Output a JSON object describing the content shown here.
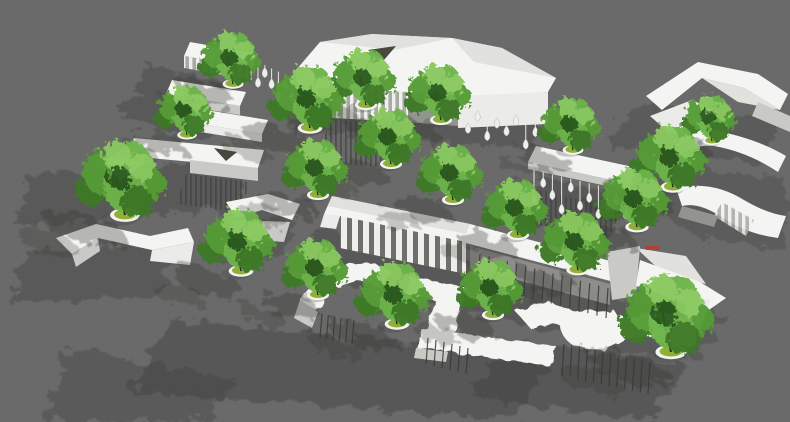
{
  "scene": {
    "width": 790,
    "height": 422,
    "description": "Aerial 3D rendering of a site model: white sculptural pavilions and canopies with green trees in round white planters on a gray ground, shadows cast toward the lower left"
  },
  "palette": {
    "ground": "#6a6a6a",
    "groundDot": "#626262",
    "shadow": "#3c3c3c",
    "treeShadow": "#35352f",
    "roof": "#f4f4f2",
    "roofShade": "#e1e1de",
    "faceLight": "#ebebe9",
    "faceMid": "#c9c9c6",
    "faceDark": "#93938f",
    "hole": "#48483f",
    "slatLight": "#f0f0ee",
    "slatDark": "#a9a9a5",
    "colLight": "#eeeeeb",
    "colDark": "#6e6e6a",
    "stick": "#383834",
    "dropLine": "#e9e9e6",
    "dropFill": "#efefec",
    "dropEdge": "#b5b5b1",
    "trunk": "#26241c",
    "canopy1": "#3c7a26",
    "canopy2": "#549c36",
    "canopy3": "#6cb44a",
    "canopy4": "#89c95f",
    "canopyDark": "#2c5a1c",
    "planterRim": "#f3f3f0",
    "planterSoil": "#90af3a",
    "redMark": "#b14233"
  },
  "shadows": [
    {
      "pts": "150,66 242,88 206,142 118,116",
      "o": 0.36
    },
    {
      "pts": "300,84 548,102 532,150 286,128",
      "o": 0.34
    },
    {
      "pts": "540,176 630,198 604,242 516,220",
      "o": 0.38
    },
    {
      "pts": "630,104 784,118 758,164 608,148",
      "o": 0.33
    },
    {
      "pts": "28,176 250,158 236,208 14,226",
      "o": 0.36
    },
    {
      "pts": "664,166 786,178 786,248 700,238 652,208",
      "o": 0.3
    },
    {
      "pts": "318,226 616,294 590,340 294,270",
      "o": 0.38
    },
    {
      "pts": "214,222 298,214 286,254 202,260",
      "o": 0.33
    },
    {
      "pts": "26,252 178,238 160,294 10,304",
      "o": 0.36
    },
    {
      "pts": "170,320 554,354 514,420 130,392",
      "o": 0.42
    },
    {
      "pts": "70,348 240,380 200,422 40,422",
      "o": 0.34
    },
    {
      "pts": "510,342 686,364 646,420 470,396",
      "o": 0.4
    },
    {
      "pts": "600,298 728,314 698,358 570,342",
      "o": 0.33
    }
  ],
  "structures": [
    {
      "name": "ribbon-stack-northwest",
      "parts": [
        {
          "shape": "poly",
          "pts": "190,42 258,54 252,68 184,56",
          "fill": "roof"
        },
        {
          "shape": "poly",
          "pts": "184,56 252,68 252,80 184,68",
          "fill": "slats"
        },
        {
          "shape": "poly",
          "pts": "172,80 246,92 240,106 166,94",
          "fill": "roof"
        },
        {
          "shape": "poly",
          "pts": "166,94 240,106 240,115 166,103",
          "fill": "faceMid"
        },
        {
          "shape": "poly",
          "pts": "194,108 268,120 262,134 188,122",
          "fill": "roof"
        },
        {
          "shape": "poly",
          "pts": "188,122 262,134 262,142 188,130",
          "fill": "faceLight"
        }
      ]
    },
    {
      "name": "main-pavilion-north",
      "parts": [
        {
          "shape": "poly",
          "pts": "296,70 320,42 372,34 452,38 502,48 556,78 548,92 472,98 394,92 318,88",
          "fill": "roof"
        },
        {
          "shape": "poly",
          "pts": "320,42 372,34 452,38 394,50",
          "fill": "roofShade"
        },
        {
          "shape": "poly",
          "pts": "452,38 502,48 556,78 474,62",
          "fill": "roofShade"
        },
        {
          "shape": "poly",
          "pts": "368,50 396,46 384,60",
          "fill": "hole"
        },
        {
          "shape": "poly",
          "pts": "332,88 408,92 408,122 332,118",
          "fill": "slats"
        },
        {
          "shape": "poly",
          "pts": "458,96 548,92 548,124 458,128",
          "fill": "faceLight"
        },
        {
          "shape": "poly",
          "pts": "408,92 458,96 458,126 408,122",
          "fill": "faceDark"
        },
        {
          "shape": "poly",
          "pts": "330,120 406,124 394,168 316,162",
          "fill": "hatch",
          "o": 0.55
        },
        {
          "shape": "poly",
          "pts": "296,70 318,88 318,100 296,82",
          "fill": "faceMid"
        }
      ]
    },
    {
      "name": "drop-lantern-gallery-east",
      "parts": [
        {
          "shape": "poly",
          "pts": "536,146 638,168 630,184 528,162",
          "fill": "roof"
        },
        {
          "shape": "poly",
          "pts": "528,162 630,184 630,191 528,169",
          "fill": "faceMid"
        },
        {
          "shape": "poly",
          "pts": "540,190 622,210 606,242 524,222",
          "fill": "hatch",
          "o": 0.5
        }
      ]
    },
    {
      "name": "chevron-canopy-northeast",
      "parts": [
        {
          "shape": "path",
          "d": "M646,96 L698,62 L758,74 L788,94 L780,110 L744,88 L702,78 L662,110 Z",
          "fill": "roof"
        },
        {
          "shape": "poly",
          "pts": "702,78 744,88 780,110 738,102",
          "fill": "roofShade"
        },
        {
          "shape": "poly",
          "pts": "650,116 692,100 718,112 700,140 668,132",
          "fill": "faceLight"
        },
        {
          "shape": "poly",
          "pts": "668,132 700,140 696,149 664,141",
          "fill": "faceDark"
        },
        {
          "shape": "poly",
          "pts": "758,102 790,116 790,132 752,116",
          "fill": "faceMid"
        }
      ]
    },
    {
      "name": "slab-pavilion-west",
      "parts": [
        {
          "shape": "poly",
          "pts": "134,138 264,150 258,168 128,156",
          "fill": "roof"
        },
        {
          "shape": "poly",
          "pts": "214,148 237,152 226,161",
          "fill": "hole"
        },
        {
          "shape": "poly",
          "pts": "106,160 134,140 146,162 118,182",
          "fill": "faceLight"
        },
        {
          "shape": "poly",
          "pts": "190,160 258,168 258,181 190,173",
          "fill": "faceMid"
        },
        {
          "shape": "poly",
          "pts": "186,174 250,182 240,212 176,204",
          "fill": "hatch",
          "o": 0.55
        }
      ]
    },
    {
      "name": "serpentine-ramp-east",
      "parts": [
        {
          "shape": "path",
          "d": "M712,130 Q756,138 786,156 L778,172 Q748,152 714,146 Q692,144 678,156 L670,144 Q688,130 712,130 Z",
          "fill": "roof"
        },
        {
          "shape": "path",
          "d": "M676,188 Q712,180 744,200 Q768,214 786,216 L778,238 Q746,234 720,216 Q698,202 682,206 Z",
          "fill": "roof"
        },
        {
          "shape": "poly",
          "pts": "722,202 754,220 746,236 714,216",
          "fill": "slats",
          "o": 0.85
        },
        {
          "shape": "poly",
          "pts": "682,206 718,216 714,227 678,217",
          "fill": "faceDark"
        }
      ]
    },
    {
      "name": "folded-bench-center-west",
      "parts": [
        {
          "shape": "poly",
          "pts": "226,202 268,194 300,204 292,220 262,210 236,218",
          "fill": "roof"
        },
        {
          "shape": "poly",
          "pts": "232,220 290,222 284,242 228,238",
          "fill": "faceMid"
        }
      ]
    },
    {
      "name": "colonnade-hall-center",
      "parts": [
        {
          "shape": "poly",
          "pts": "332,196 470,224 622,264 614,282 462,242 324,214",
          "fill": "roof"
        },
        {
          "shape": "poly",
          "pts": "332,196 470,224 466,234 328,206",
          "fill": "roofShade"
        },
        {
          "shape": "poly",
          "pts": "340,216 466,242 466,274 340,248",
          "fill": "cols"
        },
        {
          "shape": "poly",
          "pts": "470,246 610,284 610,305 470,267",
          "fill": "faceDark",
          "o": 0.85
        },
        {
          "shape": "poly",
          "pts": "324,214 340,216 336,229 320,227",
          "fill": "faceLight"
        }
      ]
    },
    {
      "name": "zigzag-ribbon-southwest",
      "parts": [
        {
          "shape": "path",
          "d": "M56,238 L96,224 L150,236 L188,228 L194,242 L152,250 L98,238 L72,254 Z",
          "fill": "roof"
        },
        {
          "shape": "poly",
          "pts": "72,254 98,238 100,251 76,267",
          "fill": "faceMid"
        },
        {
          "shape": "poly",
          "pts": "152,250 194,242 190,265 150,261",
          "fill": "faceLight"
        }
      ]
    },
    {
      "name": "meander-canopy-south",
      "parts": [
        {
          "shape": "path",
          "d": "M300,300 Q316,276 342,266 Q368,258 390,270 L382,290 Q362,278 344,284 Q326,290 318,312 Z",
          "fill": "roof",
          "flt": "wob"
        },
        {
          "shape": "poly",
          "pts": "300,300 318,312 312,328 294,318",
          "fill": "faceMid"
        },
        {
          "shape": "poly",
          "pts": "410,276 468,288 462,306 404,294",
          "fill": "roof",
          "flt": "wob"
        },
        {
          "shape": "poly",
          "pts": "436,298 462,306 452,338 426,330",
          "fill": "roof",
          "flt": "wob"
        },
        {
          "shape": "poly",
          "pts": "422,328 556,346 550,366 416,348",
          "fill": "roof",
          "flt": "wob"
        },
        {
          "shape": "poly",
          "pts": "416,348 448,352 446,362 414,358",
          "fill": "faceMid"
        }
      ]
    },
    {
      "name": "faceted-folly-southeast",
      "parts": [
        {
          "shape": "poly",
          "pts": "607,252 640,246 636,296 612,300",
          "fill": "faceMid"
        },
        {
          "shape": "poly",
          "pts": "636,248 686,256 706,284 664,274",
          "fill": "roofShade"
        },
        {
          "shape": "poly",
          "pts": "640,260 700,282 726,298 706,312 664,296 636,286",
          "fill": "roof"
        },
        {
          "shape": "poly",
          "pts": "688,296 710,300 700,330 684,318",
          "fill": "faceLight"
        },
        {
          "shape": "poly",
          "pts": "646,246 659,246 659,250 646,250",
          "fill": "redMark"
        }
      ]
    },
    {
      "name": "terrace-cluster-south",
      "parts": [
        {
          "shape": "path",
          "d": "M516,312 Q538,298 560,306 L578,312 Q598,318 614,310 L626,330 Q604,340 584,332 L564,326 Q544,320 532,330 Z",
          "fill": "roof",
          "flt": "wob"
        },
        {
          "shape": "path",
          "d": "M560,318 Q580,306 602,312 Q622,318 640,314 Q664,308 682,318 Q700,328 696,344 Q678,352 656,340 Q636,330 616,344 Q594,356 572,344 Q558,336 560,318 Z",
          "fill": "roof",
          "flt": "wob"
        }
      ]
    }
  ],
  "sticks": [
    {
      "x1": 480,
      "y1": 254,
      "x2": 608,
      "y2": 288,
      "n": 15,
      "len": 30
    },
    {
      "x1": 322,
      "y1": 314,
      "x2": 354,
      "y2": 320,
      "n": 6,
      "len": 24
    },
    {
      "x1": 428,
      "y1": 338,
      "x2": 468,
      "y2": 348,
      "n": 6,
      "len": 26
    },
    {
      "x1": 564,
      "y1": 344,
      "x2": 650,
      "y2": 362,
      "n": 12,
      "len": 32
    }
  ],
  "drops": [
    {
      "x1": 258,
      "y1": 62,
      "x2": 292,
      "y2": 78,
      "lens": [
        22,
        9,
        17,
        26,
        12,
        20
      ]
    },
    {
      "x1": 468,
      "y1": 106,
      "x2": 545,
      "y2": 119,
      "lens": [
        24,
        10,
        28,
        14,
        20,
        8,
        30,
        16,
        12
      ]
    },
    {
      "x1": 534,
      "y1": 170,
      "x2": 626,
      "y2": 192,
      "lens": [
        30,
        12,
        22,
        34,
        10,
        26,
        16,
        30,
        20,
        12,
        24
      ]
    }
  ],
  "trees": [
    [
      233,
      82,
      0.8
    ],
    [
      187,
      133,
      0.75
    ],
    [
      712,
      139,
      0.7
    ],
    [
      310,
      126,
      0.95
    ],
    [
      366,
      103,
      0.85
    ],
    [
      441,
      118,
      0.85
    ],
    [
      573,
      148,
      0.8
    ],
    [
      391,
      162,
      0.85
    ],
    [
      673,
      185,
      0.95
    ],
    [
      318,
      193,
      0.85
    ],
    [
      453,
      198,
      0.85
    ],
    [
      125,
      213,
      1.15
    ],
    [
      637,
      225,
      0.9
    ],
    [
      518,
      233,
      0.85
    ],
    [
      578,
      268,
      0.9
    ],
    [
      241,
      269,
      0.95
    ],
    [
      318,
      293,
      0.85
    ],
    [
      493,
      313,
      0.85
    ],
    [
      397,
      322,
      0.95
    ],
    [
      671,
      350,
      1.2
    ]
  ]
}
